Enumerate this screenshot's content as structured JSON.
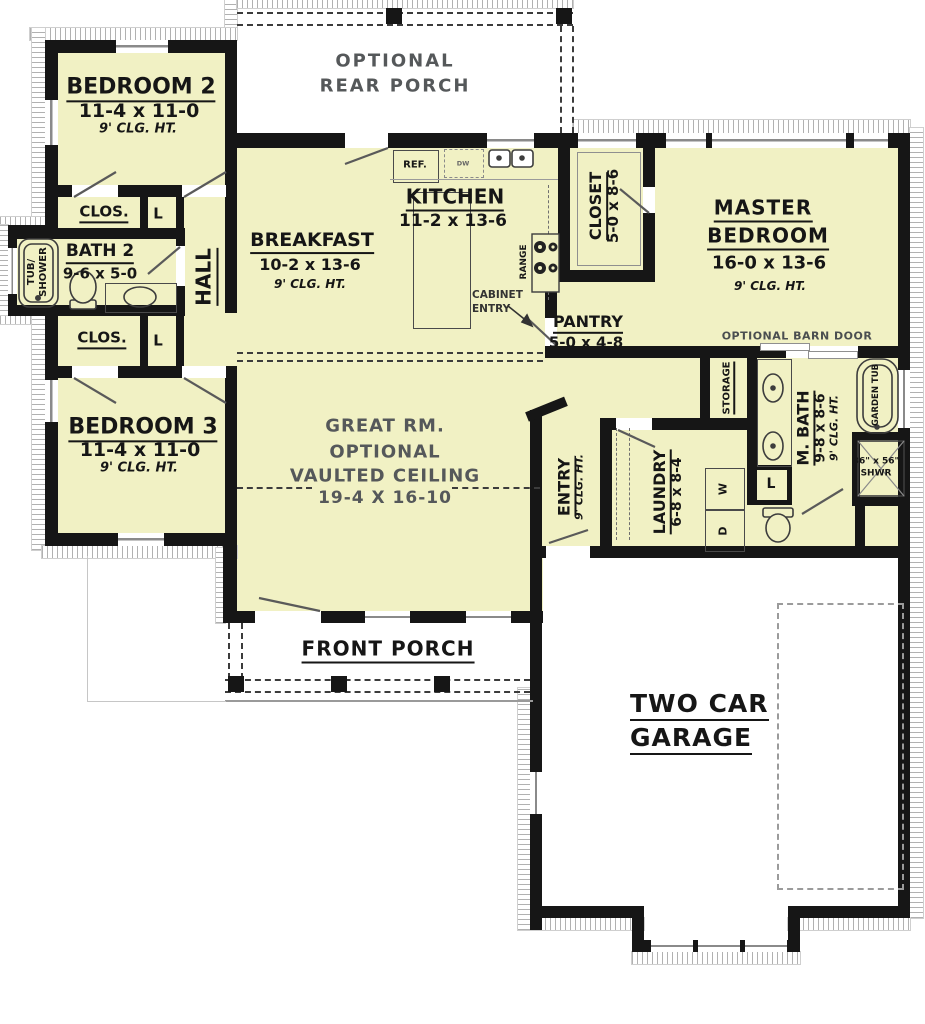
{
  "colors": {
    "floor": "#f1f1c4",
    "wall": "#161616",
    "gray_text": "#55585a",
    "hatch": "#b1b1b1"
  },
  "rooms": {
    "bedroom2": {
      "name": "BEDROOM 2",
      "dims": "11-4 x 11-0",
      "ceiling": "9' CLG. HT."
    },
    "bedroom3": {
      "name": "BEDROOM 3",
      "dims": "11-4 x 11-0",
      "ceiling": "9' CLG. HT."
    },
    "master_bedroom": {
      "name_line1": "MASTER",
      "name_line2": "BEDROOM",
      "dims": "16-0 x 13-6",
      "ceiling": "9' CLG. HT."
    },
    "kitchen": {
      "name": "KITCHEN",
      "dims": "11-2 x 13-6"
    },
    "breakfast": {
      "name": "BREAKFAST",
      "dims": "10-2 x 13-6",
      "ceiling": "9' CLG. HT."
    },
    "great_room": {
      "line1": "GREAT RM.",
      "line2": "OPTIONAL",
      "line3": "VAULTED CEILING",
      "line4": "19-4 X 16-10"
    },
    "rear_porch": {
      "line1": "OPTIONAL",
      "line2": "REAR PORCH"
    },
    "front_porch": {
      "name": "FRONT PORCH"
    },
    "garage": {
      "line1": "TWO CAR",
      "line2": "GARAGE"
    },
    "bath2": {
      "name": "BATH 2",
      "dims": "9-6 x 5-0"
    },
    "master_bath": {
      "name": "M. BATH",
      "dims": "9-8 x 8-6",
      "ceiling": "9' CLG. HT."
    },
    "master_closet": {
      "name": "CLOSET",
      "dims": "5-0 x 8-6"
    },
    "pantry": {
      "name": "PANTRY",
      "dims": "5-0 x 4-8"
    },
    "entry": {
      "name": "ENTRY",
      "ceiling": "9' CLG. HT."
    },
    "laundry": {
      "name": "LAUNDRY",
      "dims": "6-8 x 8-4"
    },
    "hall": {
      "name": "HALL"
    },
    "storage": {
      "name": "STORAGE"
    },
    "closet_upper": {
      "name": "CLOS."
    },
    "closet_lower": {
      "name": "CLOS."
    }
  },
  "fixtures": {
    "tub_shower": {
      "line1": "TUB/",
      "line2": "SHOWER"
    },
    "garden_tub": "GARDEN TUB",
    "shower": {
      "line1": "36\" x 56\"",
      "line2": "SHWR"
    },
    "refrigerator": "REF.",
    "dishwasher": "DW",
    "range": "RANGE",
    "washer": "W",
    "dryer": "D",
    "linen": "L"
  },
  "annotations": {
    "cabinet_entry_line1": "CABINET",
    "cabinet_entry_line2": "ENTRY",
    "barn_door": "OPTIONAL BARN DOOR"
  }
}
